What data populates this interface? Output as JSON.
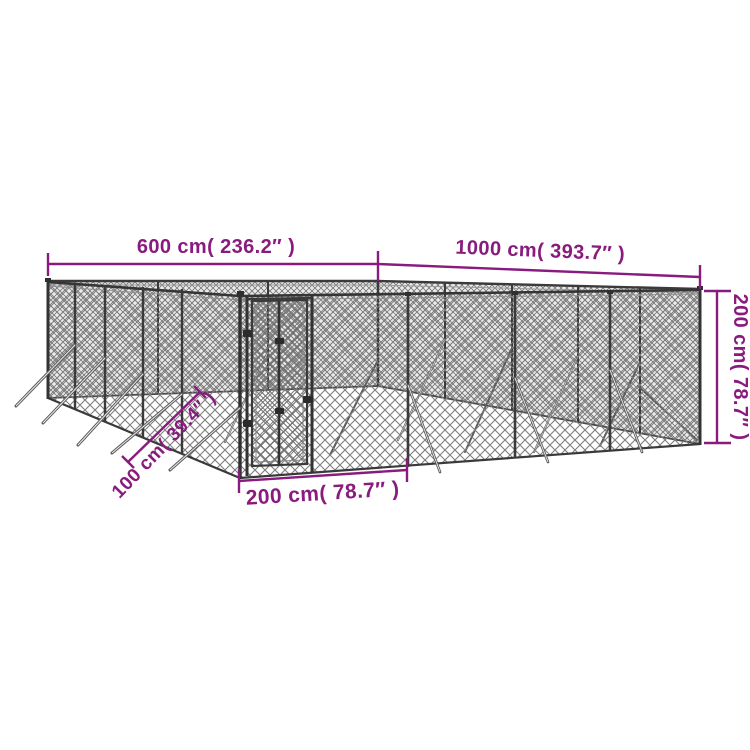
{
  "diagram": {
    "type": "product-dimension-diagram",
    "subject": "outdoor chain-link dog kennel with gate",
    "accent_color": "#8a1b7e",
    "structure_color": "#3a3a3a",
    "background_color": "#ffffff",
    "dimensions": {
      "back_left_width": {
        "label": "600 cm( 236.2″ )",
        "value_cm": 600,
        "value_in": 236.2
      },
      "back_right_length": {
        "label": "1000 cm( 393.7″ )",
        "value_cm": 1000,
        "value_in": 393.7
      },
      "height": {
        "label": "200 cm( 78.7″ )",
        "value_cm": 200,
        "value_in": 78.7
      },
      "gate_section_width": {
        "label": "200 cm( 78.7″ )",
        "value_cm": 200,
        "value_in": 78.7
      },
      "ground_brace_length": {
        "label": "100 cm( 39.4″ )",
        "value_cm": 100,
        "value_in": 39.4
      }
    }
  }
}
